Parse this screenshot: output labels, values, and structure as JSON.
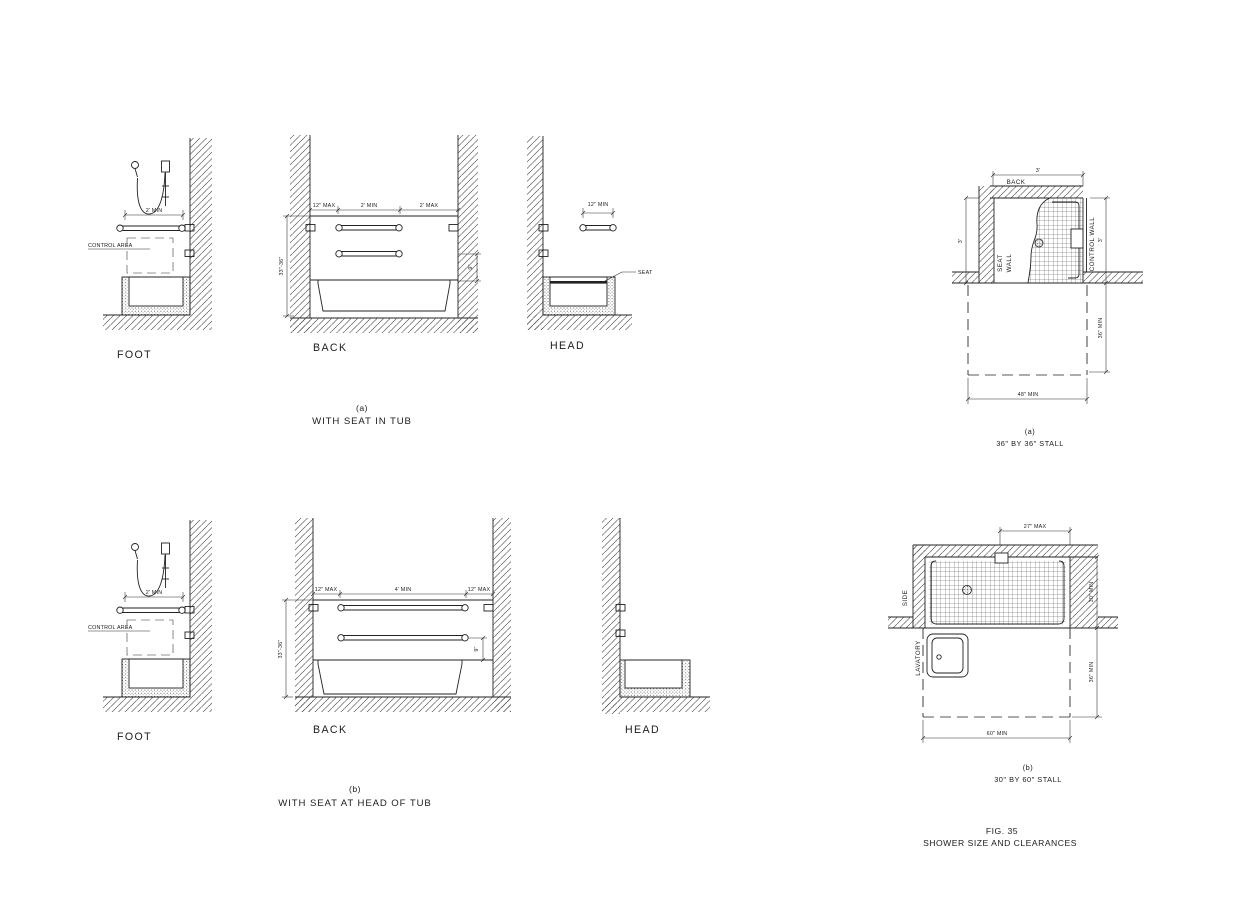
{
  "tub_a": {
    "caption_tag": "(a)",
    "caption": "WITH SEAT IN TUB",
    "foot": {
      "label": "FOOT",
      "bar_dim": "2' MIN",
      "control_area": "CONTROL AREA"
    },
    "back": {
      "label": "BACK",
      "dim_left": "12\" MAX",
      "dim_mid": "2' MIN",
      "dim_right": "2' MAX",
      "height_dim": "33\"-36\"",
      "gap_dim": "9\""
    },
    "head": {
      "label": "HEAD",
      "bar_dim": "12\" MIN",
      "seat": "SEAT"
    }
  },
  "tub_b": {
    "caption_tag": "(b)",
    "caption": "WITH SEAT AT HEAD OF TUB",
    "foot": {
      "label": "FOOT",
      "bar_dim": "2' MIN",
      "control_area": "CONTROL AREA"
    },
    "back": {
      "label": "BACK",
      "dim_left": "12\" MAX",
      "dim_mid": "4' MIN",
      "dim_right": "12\" MAX",
      "height_dim": "33\"-36\"",
      "gap_dim": "9\""
    },
    "head": {
      "label": "HEAD"
    }
  },
  "stall_a": {
    "caption_tag": "(a)",
    "caption": "36\" BY 36\" STALL",
    "back": "BACK",
    "seat_wall_1": "SEAT",
    "seat_wall_2": "WALL",
    "control_wall": "CONTROL WALL",
    "dim_top": "3'",
    "dim_left": "3'",
    "dim_right": "3'",
    "dim_clear_depth": "36\" MIN",
    "dim_clear_width": "48\" MIN"
  },
  "stall_b": {
    "caption_tag": "(b)",
    "caption": "30\" BY 60\" STALL",
    "side": "SIDE",
    "lavatory": "LAVATORY",
    "dim_top": "27\" MAX",
    "dim_depth": "30\" MIN",
    "dim_clear_depth": "36\" MIN",
    "dim_width": "60\" MIN"
  },
  "figure": {
    "title_line1": "FIG. 35",
    "title_line2": "SHOWER SIZE AND CLEARANCES"
  }
}
